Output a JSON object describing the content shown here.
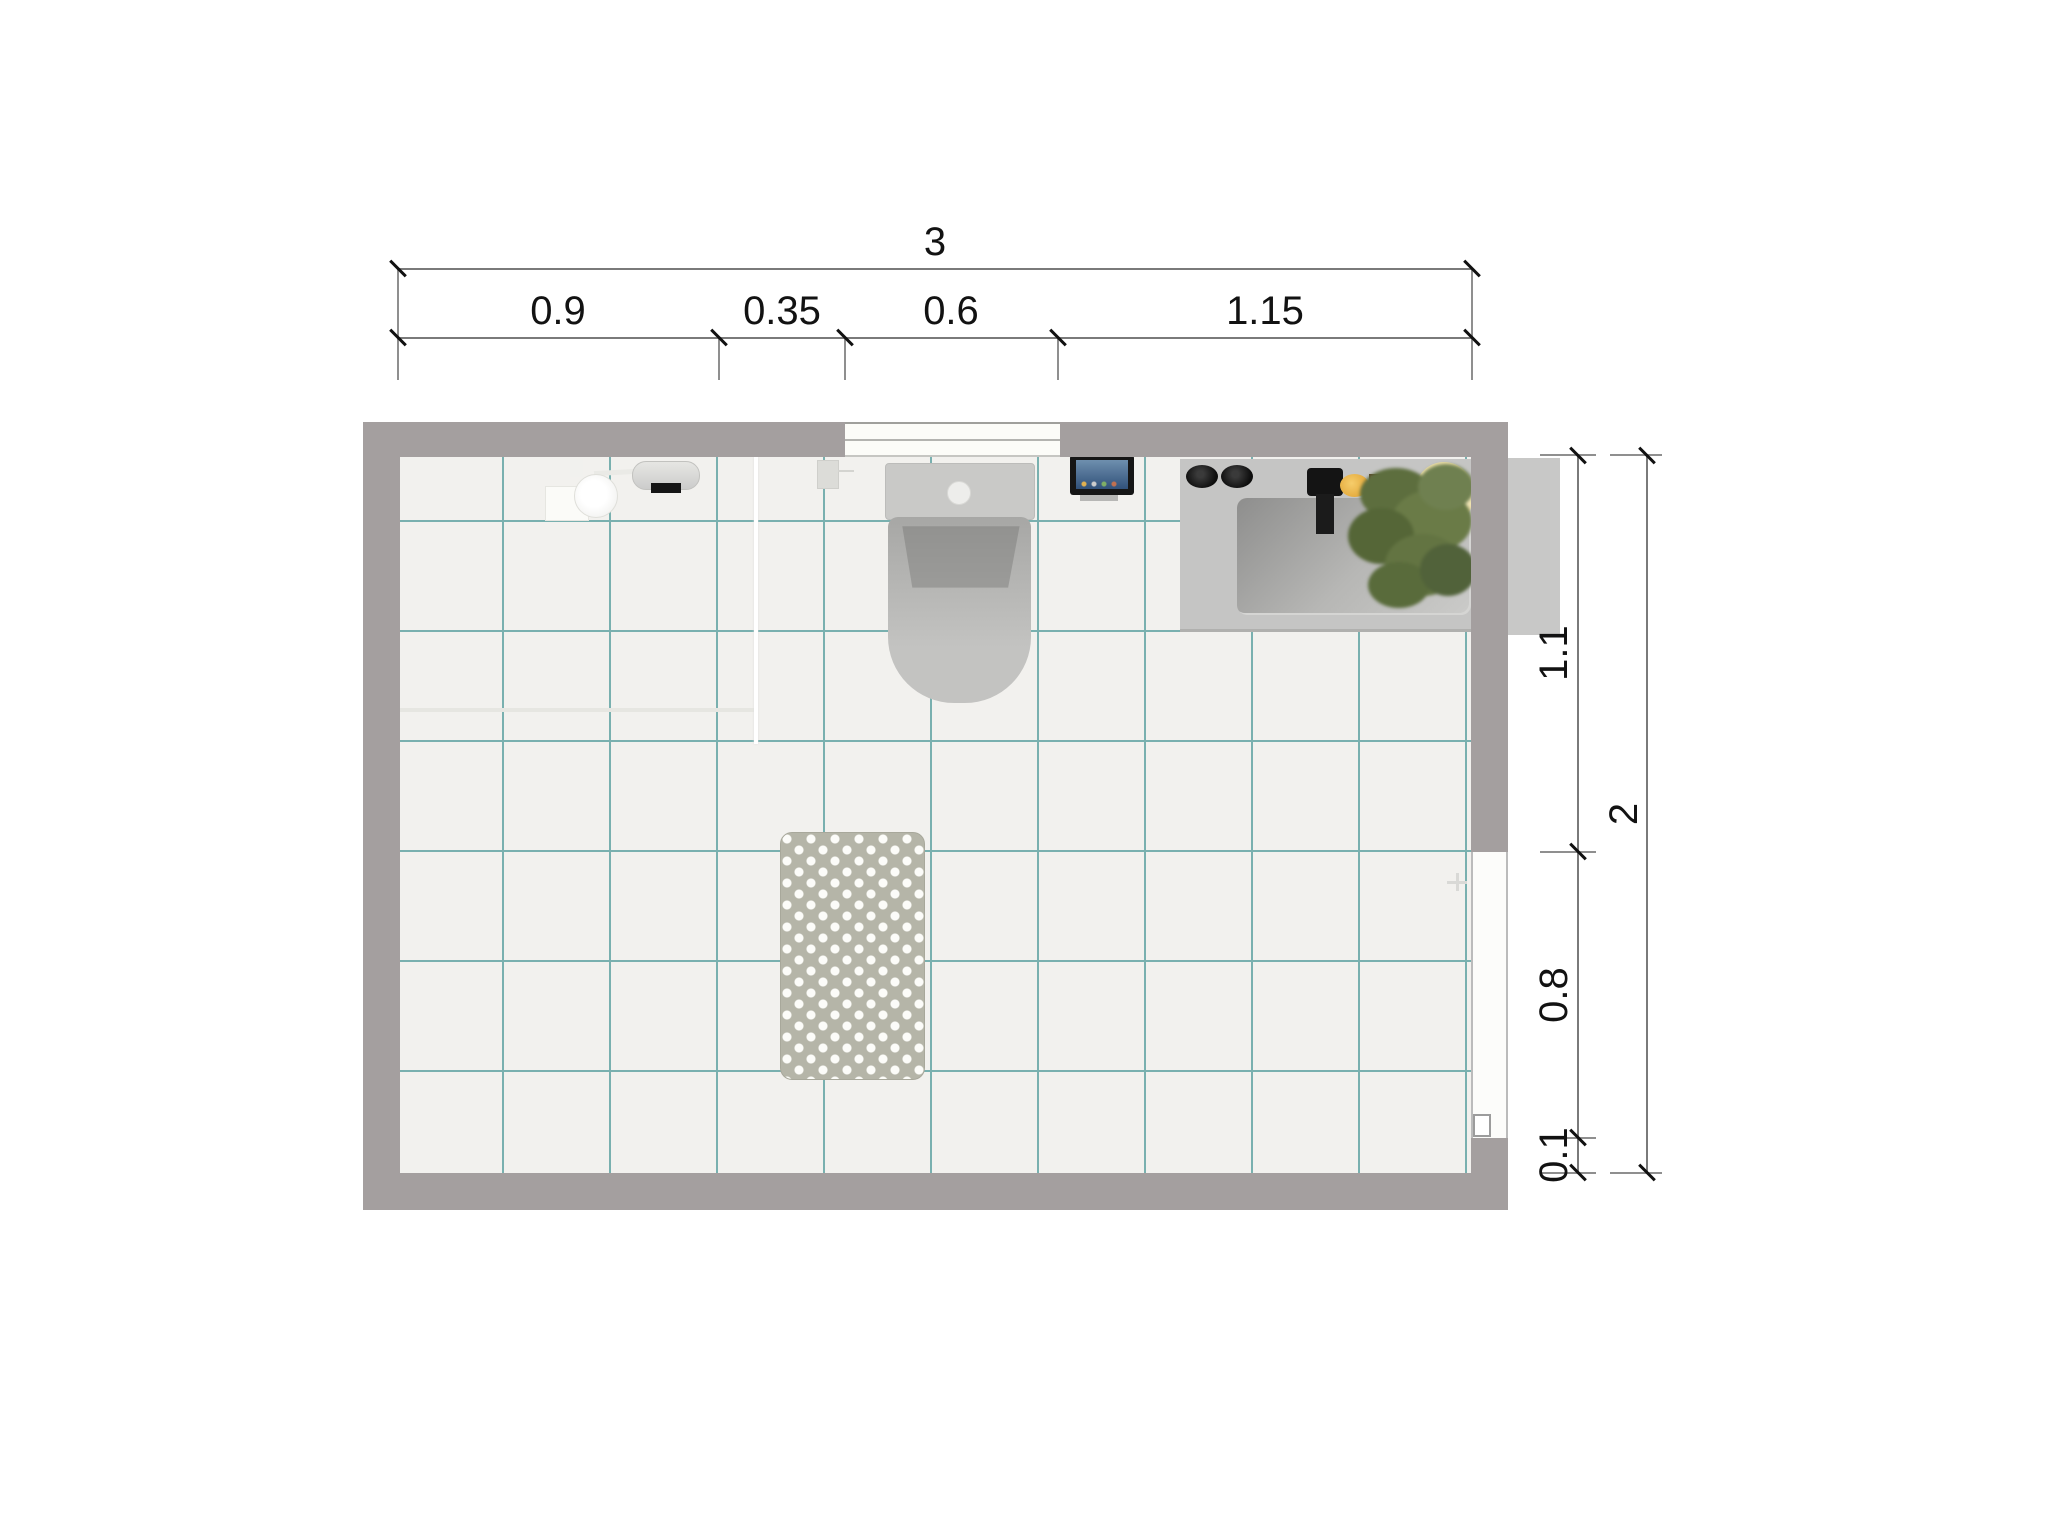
{
  "dimensions": {
    "top_total": {
      "label": "3"
    },
    "top_segments": [
      {
        "label": "0.9"
      },
      {
        "label": "0.35"
      },
      {
        "label": "0.6"
      },
      {
        "label": "1.15"
      }
    ],
    "right_total": {
      "label": "2"
    },
    "right_segments": [
      {
        "label": "1.1"
      },
      {
        "label": "0.8"
      },
      {
        "label": "0.1"
      }
    ]
  },
  "room": {
    "fixtures": [
      "shower-head",
      "shower-wall-cylinder",
      "shower-glass-panel",
      "toilet",
      "wall-tablet",
      "vanity-counter",
      "sink-basin",
      "faucet",
      "faucet-knobs",
      "soap",
      "soap-dish",
      "plant",
      "bath-mat",
      "window",
      "door-opening"
    ],
    "colors": {
      "wall": "#a49f9f",
      "floor": "#f2f1ee",
      "tile_grout": "#79b0af",
      "counter": "#c5c5c4",
      "mat": "#b5b5a8",
      "dimension_text": "#121212",
      "dimension_line": "#7a7a7a",
      "plant_green": "#5f7040",
      "soap_yellow": "#e9a93a",
      "tablet_screen": "#3f6391"
    }
  }
}
